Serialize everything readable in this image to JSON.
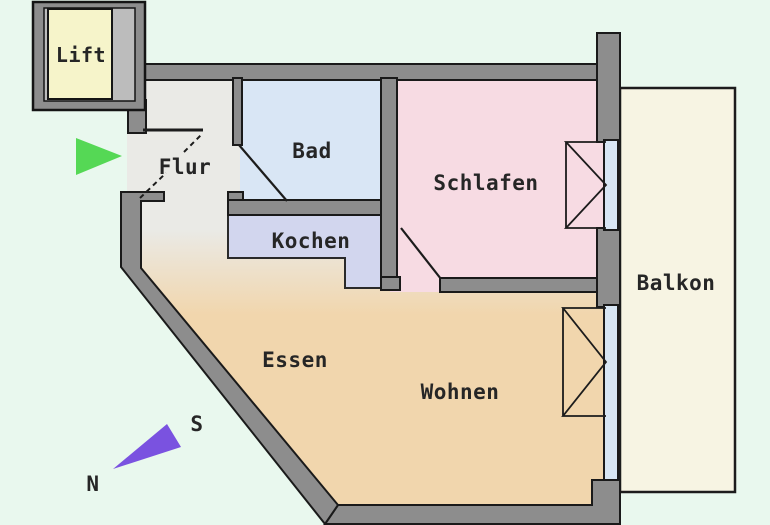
{
  "plan": {
    "colors": {
      "background": "#e9f8ee",
      "wall": "#8d8d8d",
      "glass": "#d8e6f4",
      "lift_shaft_inner": "#bcbcbc"
    },
    "rooms": {
      "lift": {
        "label": "Lift",
        "color": "#f6f4ca"
      },
      "flur": {
        "label": "Flur",
        "color": "#eaeae6"
      },
      "bad": {
        "label": "Bad",
        "color": "#d9e6f5"
      },
      "kochen": {
        "label": "Kochen",
        "color": "#d2d6ee"
      },
      "schlafen": {
        "label": "Schlafen",
        "color": "#f7dbe3"
      },
      "essen": {
        "label": "Essen",
        "color": "#f1d6ad"
      },
      "wohnen": {
        "label": "Wohnen",
        "color": "#f1d6ad"
      },
      "balkon": {
        "label": "Balkon",
        "color": "#f7f4e3"
      }
    },
    "compass": {
      "south": "S",
      "north": "N",
      "needle_color": "#7a52e0"
    },
    "entrance_arrow": {
      "color": "#55d855"
    }
  }
}
